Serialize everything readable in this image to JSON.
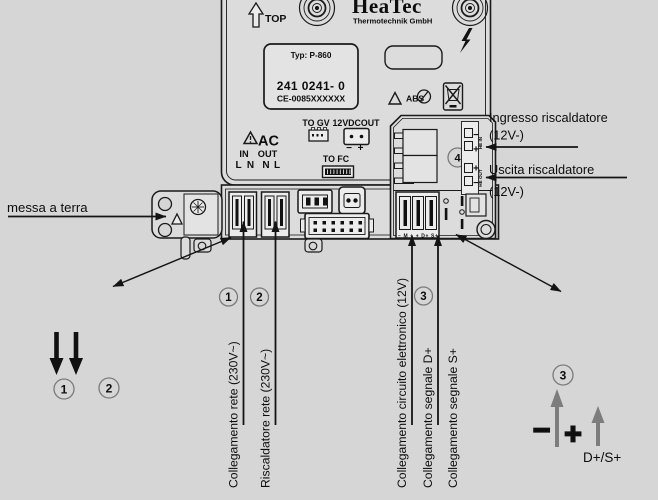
{
  "header": {
    "top_label": "TOP",
    "brand": "HeaTec",
    "brand_sub": "Thermotechnik GmbH"
  },
  "plate": {
    "typ": "Typ: P-860",
    "part": "241 0241- 0",
    "ce": "CE-0085XXXXXX"
  },
  "markings": {
    "abs": "ABS"
  },
  "ports": {
    "to_gv": "TO GV",
    "vdcout": "12VDCOUT",
    "vdc_minus": "−",
    "vdc_plus": "+",
    "ac": "AC",
    "ac_in": "IN",
    "ac_out": "OUT",
    "l": "L",
    "n": "N",
    "to_fc": "TO FC"
  },
  "module": {
    "num": "4",
    "minus": "−",
    "plus": "+",
    "in_label": "HE IN",
    "out_label": "HE OUT",
    "term_row": "− M +  + D+ S+"
  },
  "callouts": {
    "ground": "messa a terra",
    "heater_in_1": "Ingresso riscaldatore",
    "heater_in_2": "(12V-)",
    "heater_out_1": "Uscita riscaldatore",
    "heater_out_2": "(12V-)",
    "num1": "1",
    "num2": "2",
    "num3": "3",
    "label_mains": "Collegamento rete (230V~)",
    "label_heater": "Riscaldatore rete (230V~)",
    "label_electronic": "Collegamento circuito elettronico (12V)",
    "label_dplus": "Collegamento segnale D+",
    "label_splus": "Collegamento segnale S+",
    "br_minus": "−",
    "br_plus": "+",
    "br_signal": "D+/S+"
  }
}
